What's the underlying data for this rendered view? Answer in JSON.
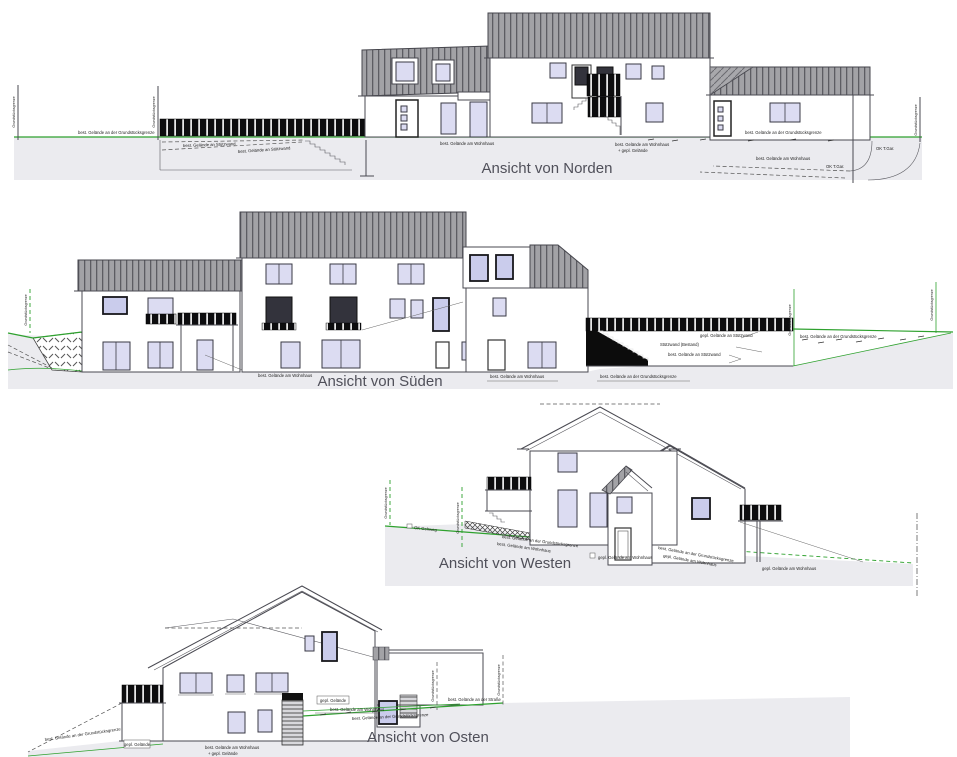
{
  "drawing": {
    "type": "building elevation sheet",
    "views": [
      {
        "id": "norden",
        "title": "Ansicht von Norden"
      },
      {
        "id": "sueden",
        "title": "Ansicht von Süden"
      },
      {
        "id": "westen",
        "title": "Ansicht von Westen"
      },
      {
        "id": "osten",
        "title": "Ansicht von Osten"
      }
    ]
  },
  "labels": {
    "bestGrenze": "best. Gelände an der Grundstücksgrenze",
    "bestWohnhaus": "best. Gelände am Wohnhaus",
    "bestStuetzwand": "best. Gelände an Stützwand",
    "geplStuetzwand": "gepl. Gelände an Stützwand",
    "gepl": "gepl. Gelände",
    "geplPlus": "+ gepl. Gelände",
    "stuetzwandBestand": "Stützwand (Bestand)",
    "bestStrasse": "best. Gelände an der Straße",
    "geplWohnhaus": "gepl. Gelände am Wohnhaus",
    "grenze": "Grundstücksgrenze",
    "okTg": "OK T.Gar.",
    "okGehweg": "OK Gehweg"
  },
  "colors": {
    "terrain_green": "#2ea12e",
    "roof_gray": "#a2a2a6",
    "roof_stripe": "#5c5c62",
    "ground_fill": "#ebebef",
    "window_glass": "#dcdcf2",
    "railing_black": "#0d0d0f",
    "line": "#4a4a52",
    "title_text": "#50505a"
  }
}
